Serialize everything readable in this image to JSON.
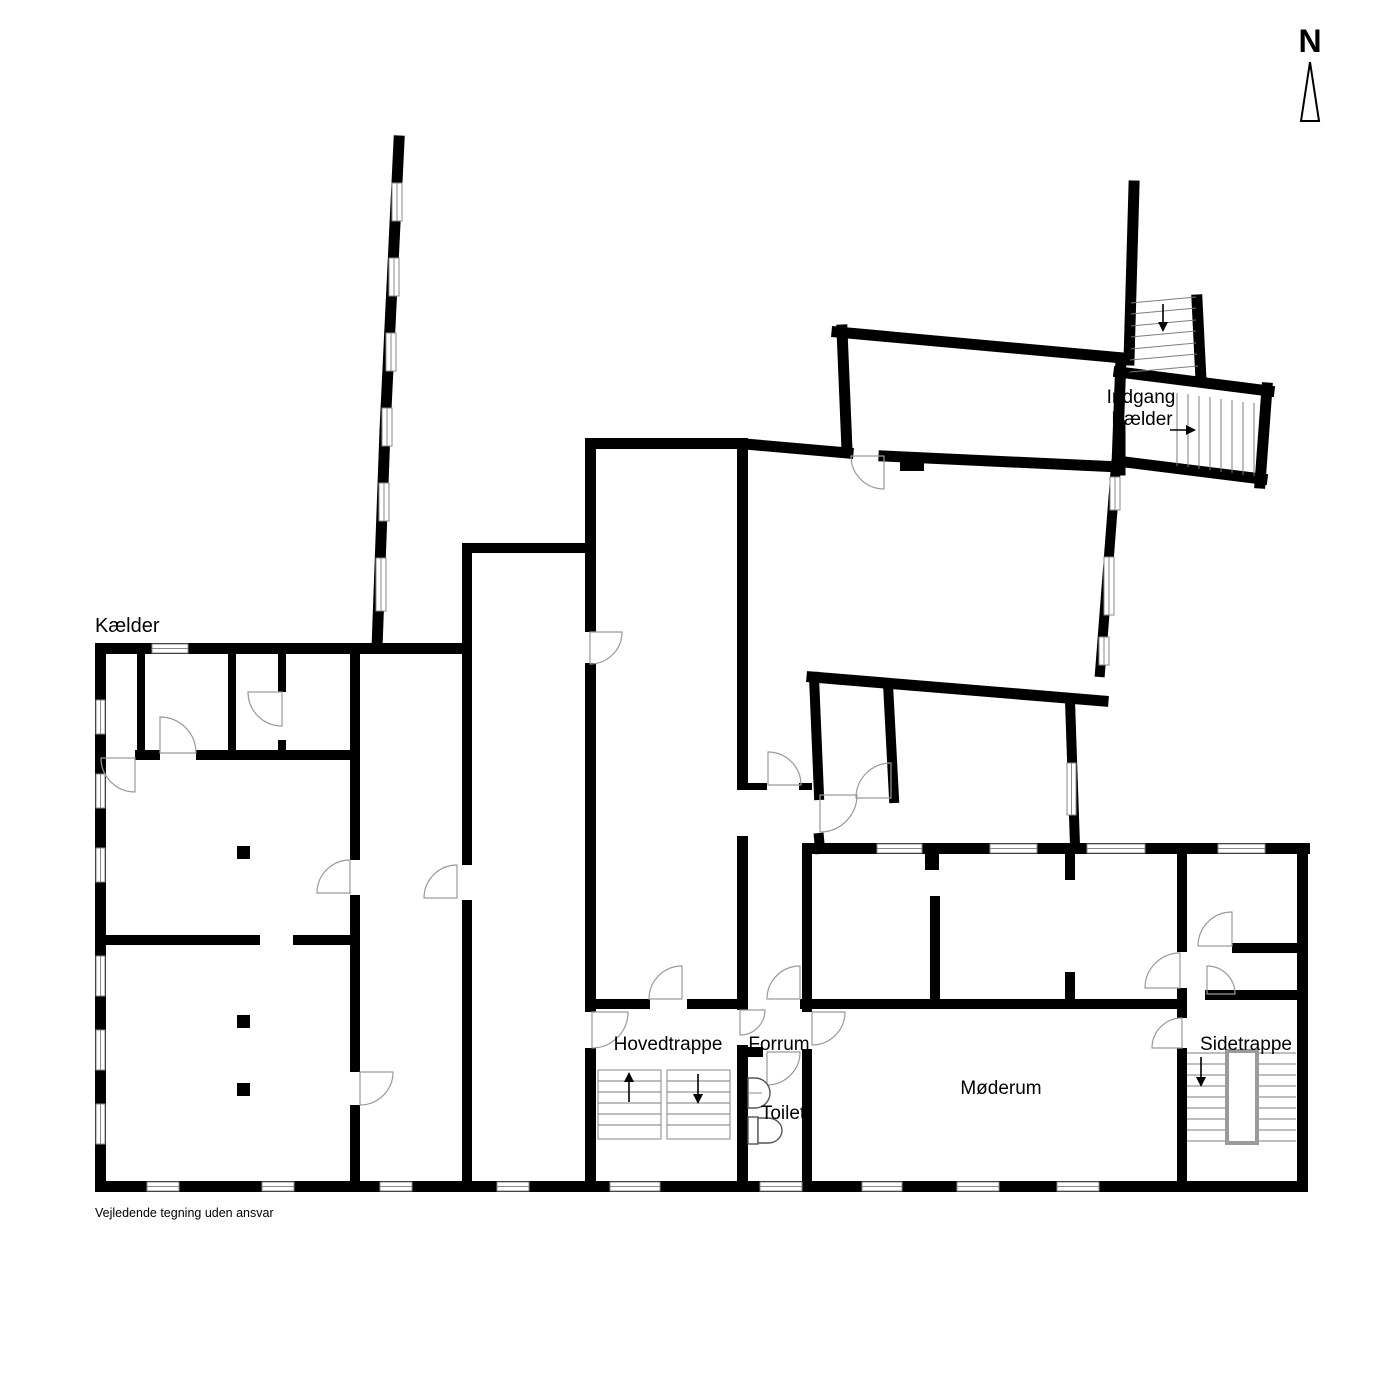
{
  "floor_plan": {
    "floor_label": "Kælder",
    "compass_letter": "N",
    "entrance_label": {
      "line1": "Indgang",
      "line2": "Kælder"
    },
    "rooms": [
      {
        "id": "hovedtrappe",
        "label": "Hovedtrappe"
      },
      {
        "id": "forrum",
        "label": "Forrum"
      },
      {
        "id": "toilet",
        "label": "Toilet"
      },
      {
        "id": "moederum",
        "label": "Møderum"
      },
      {
        "id": "sidetrappe",
        "label": "Sidetrappe"
      }
    ],
    "disclaimer": "Vejledende tegning uden ansvar",
    "colors": {
      "wall": "#000000",
      "background": "#ffffff",
      "door_arc": "#9a9a9a",
      "stair_line": "#7d7d7d",
      "window_line": "#8a8a8a"
    }
  }
}
